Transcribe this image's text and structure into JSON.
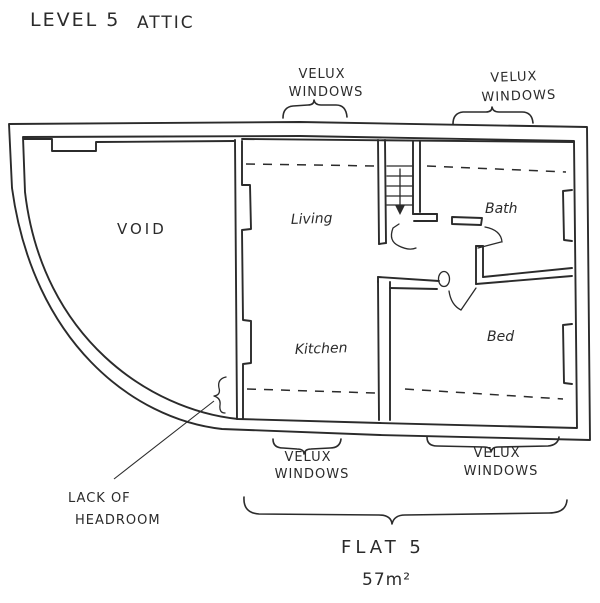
{
  "colors": {
    "ink": "#2b2b2b",
    "paper": "#ffffff"
  },
  "title": {
    "part1": "LEVEL 5",
    "part2": "ATTIC"
  },
  "rooms": {
    "void": "VOID",
    "living": "Living",
    "kitchen": "Kitchen",
    "bath": "Bath",
    "bed": "Bed"
  },
  "windows": {
    "top_left": {
      "line1": "VELUX",
      "line2": "WINDOWS"
    },
    "top_right": {
      "line1": "VELUX",
      "line2": "WINDOWS"
    },
    "bottom_left": {
      "line1": "VELUX",
      "line2": "WINDOWS"
    },
    "bottom_right": {
      "line1": "VELUX",
      "line2": "WINDOWS"
    }
  },
  "notes": {
    "lack_of_headroom": {
      "line1": "LACK OF",
      "line2": "HEADROOM"
    }
  },
  "flat": {
    "name": "FLAT 5",
    "area": "57m²"
  },
  "icons": {
    "stairs_direction_icon": "down-arrow"
  }
}
